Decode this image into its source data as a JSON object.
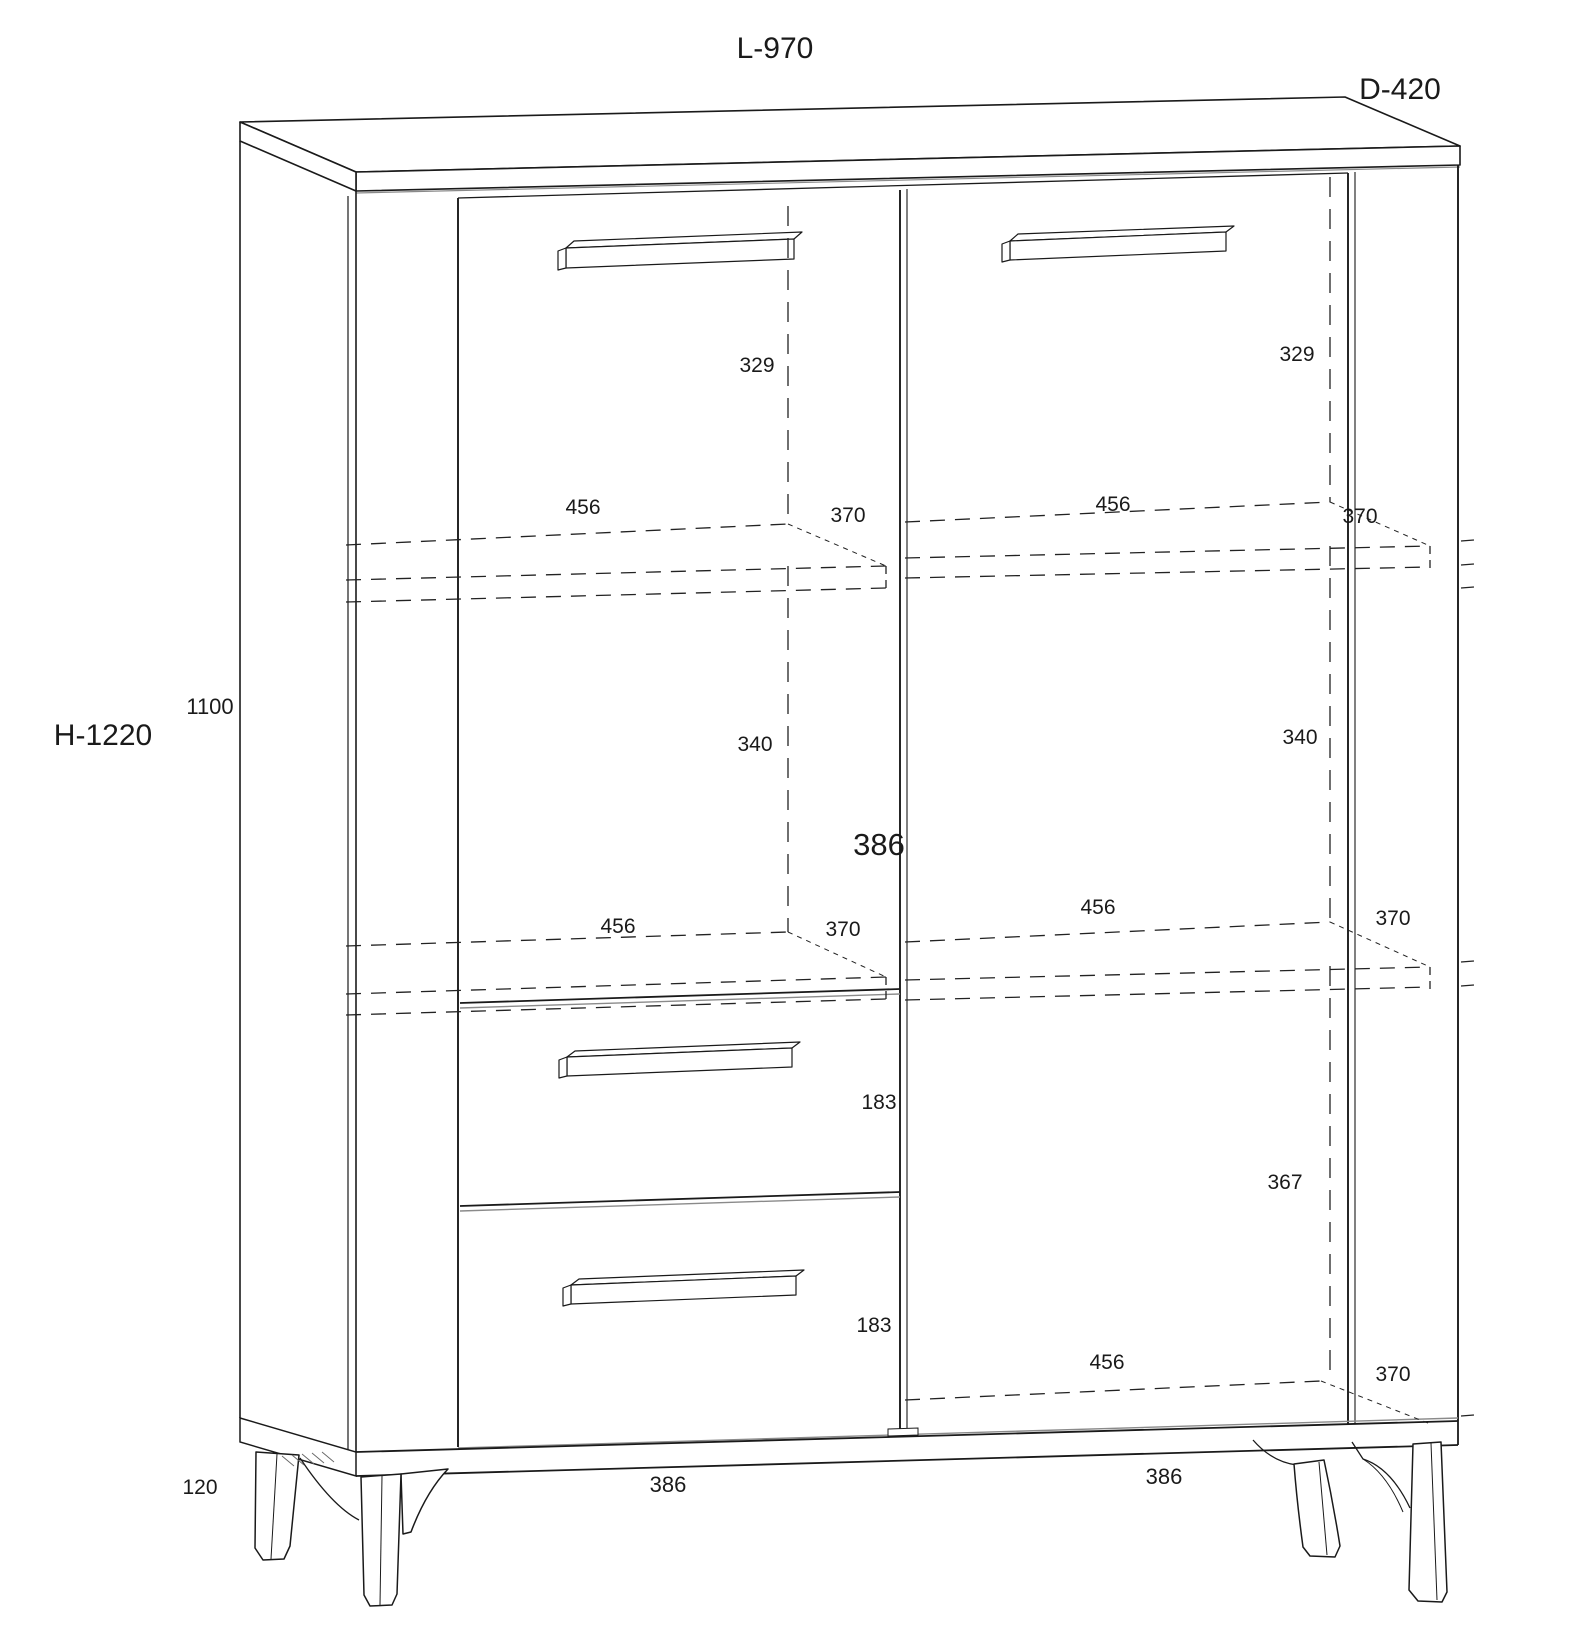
{
  "drawing": {
    "kind": "furniture technical line drawing",
    "item": "two-door sideboard cabinet with two drawers, hidden shelves and four angled legs",
    "colors": {
      "background": "#ffffff",
      "line": "#1a1a1a",
      "shadow_line": "#8a8a8a"
    }
  },
  "labels": {
    "overall_width": "L-970",
    "overall_depth": "D-420",
    "overall_height": "H-1220",
    "carcass_height": "1100",
    "leg_height": "120",
    "left_handle_offset": "329",
    "right_handle_offset": "329",
    "shelf1_left_width": "456",
    "shelf1_left_depth": "370",
    "shelf1_right_width": "456",
    "shelf1_right_depth": "370",
    "mid_left_height": "340",
    "mid_right_height": "340",
    "interior_width": "386",
    "shelf2_left_width": "456",
    "shelf2_left_depth": "370",
    "shelf2_right_width": "456",
    "shelf2_right_depth": "370",
    "drawer1_height": "183",
    "drawer2_height": "183",
    "right_lower_height": "367",
    "bottom_shelf_right_width": "456",
    "bottom_shelf_right_depth": "370",
    "base_width_left": "386",
    "base_width_right": "386"
  }
}
